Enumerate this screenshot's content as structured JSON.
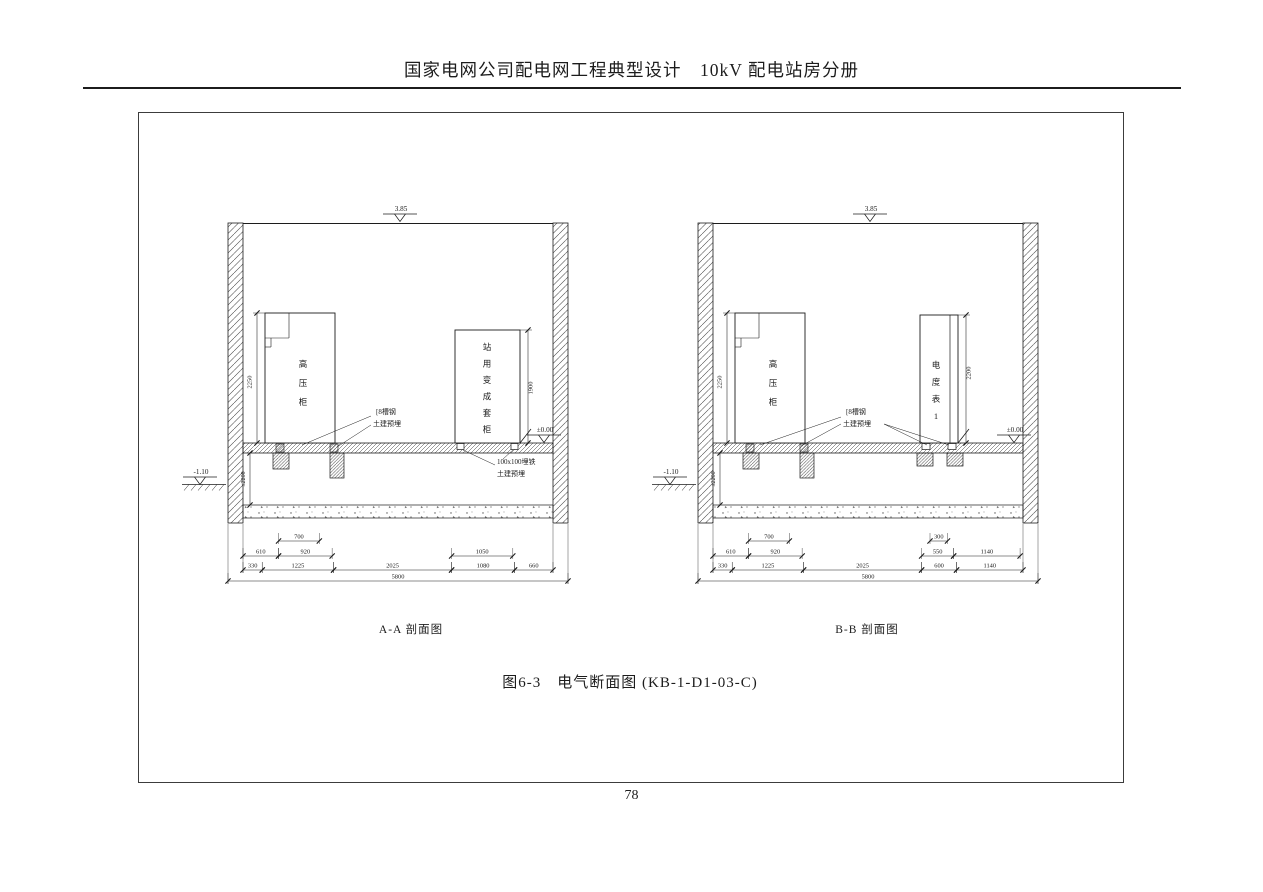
{
  "page": {
    "header": "国家电网公司配电网工程典型设计　10kV 配电站房分册",
    "figure_title": "图6-3　电气断面图 (KB-1-D1-03-C)",
    "page_number": "78"
  },
  "sections": [
    {
      "caption": "A-A 剖面图",
      "top_elevation": "3.85",
      "floor_elevation": "±0.00",
      "ground_elevation": "-1.10",
      "underfloor_depth": "≤2200",
      "cabinet1_label": "高压柜",
      "cabinet1_height": "2250",
      "cabinet2_label": "站用变成套柜",
      "cabinet2_height": "1900",
      "channel_note": [
        "[8槽钢",
        "土建预埋"
      ],
      "embed_note": [
        "100x100埋铁",
        "土建预埋"
      ],
      "dims": {
        "row1": [
          "700"
        ],
        "row2": [
          "610",
          "920",
          "1050"
        ],
        "row3": [
          "330",
          "1225",
          "2025",
          "1080",
          "660"
        ],
        "total": "5800"
      }
    },
    {
      "caption": "B-B 剖面图",
      "top_elevation": "3.85",
      "floor_elevation": "±0.00",
      "ground_elevation": "-1.10",
      "underfloor_depth": "≤2200",
      "cabinet1_label": "高压柜",
      "cabinet1_height": "2250",
      "cabinet2_label": "电度表1",
      "cabinet2_height": "2200",
      "channel_note": [
        "[8槽钢",
        "土建预埋"
      ],
      "dims": {
        "row1": [
          "700",
          "300"
        ],
        "row2": [
          "610",
          "920",
          "550",
          "1140"
        ],
        "row3": [
          "330",
          "1225",
          "2025",
          "600",
          "1140"
        ],
        "total": "5800"
      }
    }
  ]
}
